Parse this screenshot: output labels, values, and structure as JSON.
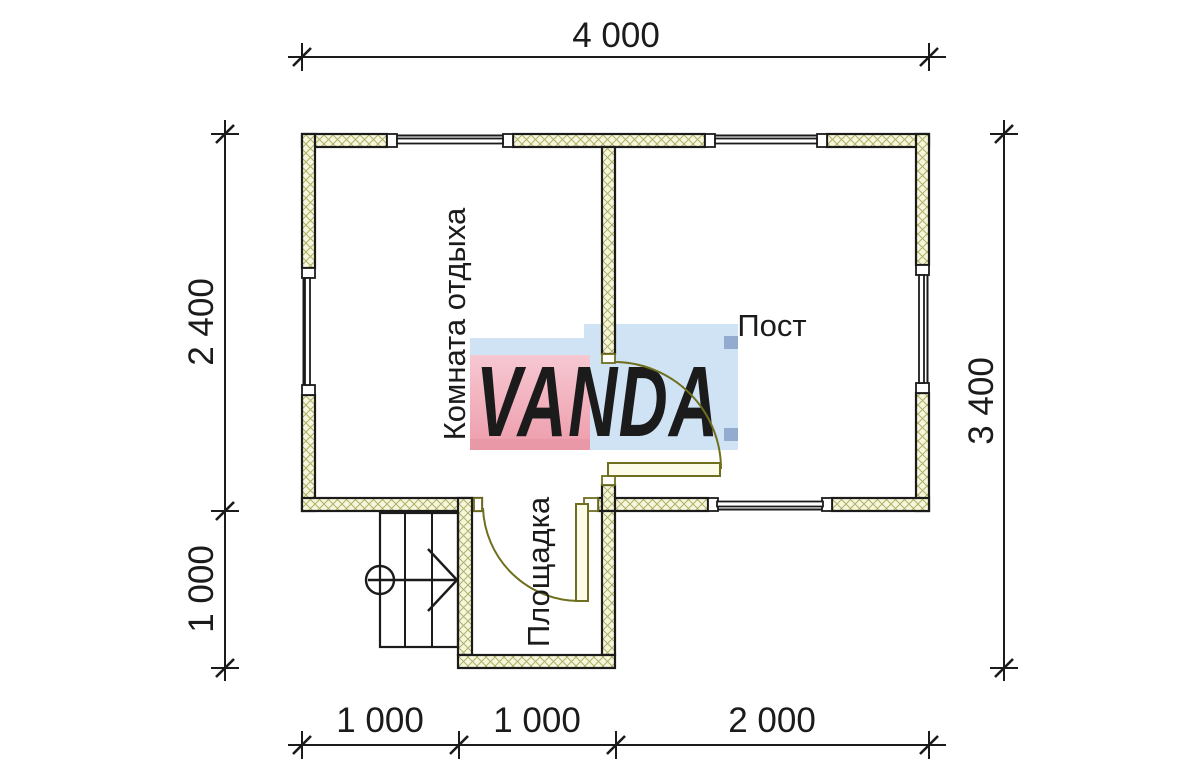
{
  "drawing": {
    "type": "floor-plan",
    "rooms": {
      "rest_room": "Комната отдыха",
      "post_room": "Пост",
      "landing": "Площадка"
    },
    "dimensions": {
      "top_total": "4 000",
      "bottom_segments": [
        "1 000",
        "1 000",
        "2 000"
      ],
      "left_segments": [
        "2 400",
        "1 000"
      ],
      "right_total": "3 400"
    },
    "watermark": {
      "text": "VANDA"
    },
    "colors": {
      "wall_fill": "#f6f6dd",
      "wall_hatch": "#b0b068",
      "outline": "#1b1b1b",
      "door": "#6f6f1f",
      "door_leaf_fill": "#fcfce8",
      "logo_pink": "#f2b5c2",
      "logo_pink_dark": "#e998a8",
      "logo_blue": "#cfe3f4",
      "logo_blue_dark": "#92abce",
      "logo_text": "#fdfdfd"
    }
  }
}
